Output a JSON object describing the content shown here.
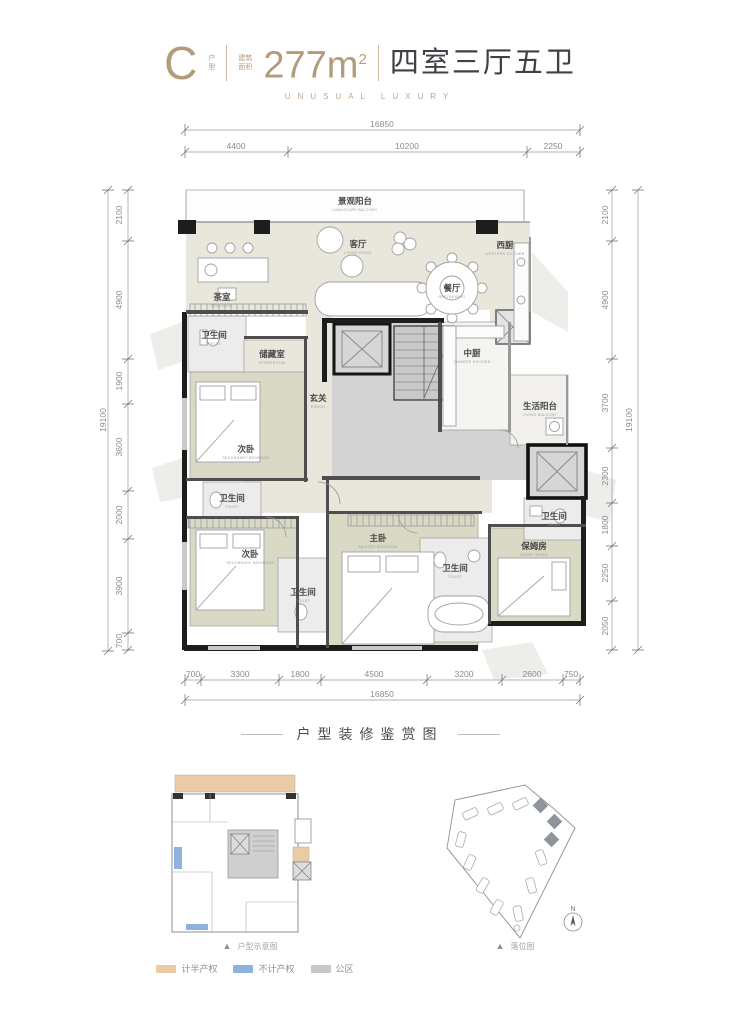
{
  "header": {
    "type_letter": "C",
    "type_suffix_top": "户",
    "type_suffix_bottom": "型",
    "area_prefix_top": "建筑",
    "area_prefix_bottom": "面积",
    "area_value": "277m",
    "area_sup": "2",
    "layout_text": "四室三厅五卫",
    "tagline": "UNUSUAL LUXURY"
  },
  "dims": {
    "top": {
      "total": "16850",
      "segments": [
        "4400",
        "10200",
        "2250"
      ]
    },
    "bottom": {
      "total": "16850",
      "segments": [
        "700",
        "3300",
        "1800",
        "4500",
        "3200",
        "2600",
        "750"
      ]
    },
    "left": {
      "total": "19100",
      "segments": [
        "2100",
        "4900",
        "1900",
        "3600",
        "2000",
        "3900",
        "700"
      ]
    },
    "right": {
      "total": "19100",
      "segments": [
        "2100",
        "4900",
        "3700",
        "2300",
        "1800",
        "2250",
        "2050"
      ]
    }
  },
  "rooms": {
    "balcony": {
      "name": "景观阳台",
      "en": "LANDSCAPE BALCONY"
    },
    "tearoom": {
      "name": "茶室",
      "en": "TEAHOUSE"
    },
    "living": {
      "name": "客厅",
      "en": "LIVING ROOM"
    },
    "dining": {
      "name": "餐厅",
      "en": "RESTAURANT"
    },
    "west_kitchen": {
      "name": "西厨",
      "en": "WESTERN KITCHEN"
    },
    "toilet1": {
      "name": "卫生间",
      "en": "TOILET"
    },
    "storeroom": {
      "name": "储藏室",
      "en": "STOREROOM"
    },
    "bedroom1": {
      "name": "次卧",
      "en": "SECONDARY BEDROOM"
    },
    "porch": {
      "name": "玄关",
      "en": "PORCH"
    },
    "chinese_kitchen": {
      "name": "中厨",
      "en": "CHINESE KITCHEN"
    },
    "life_balcony": {
      "name": "生活阳台",
      "en": "LIVING BALCONY"
    },
    "toilet2": {
      "name": "卫生间",
      "en": "TOILET"
    },
    "bedroom2": {
      "name": "次卧",
      "en": "SECONDARY BEDROOM"
    },
    "toilet3": {
      "name": "卫生间",
      "en": "TOILET"
    },
    "master": {
      "name": "主卧",
      "en": "MASTER BEDROOM"
    },
    "toilet4": {
      "name": "卫生间",
      "en": "TOILET"
    },
    "nanny": {
      "name": "保姆房",
      "en": "NANNY ROOM"
    },
    "toilet5": {
      "name": "卫生间",
      "en": "TOILET"
    }
  },
  "section2": {
    "title": "户型装修鉴赏图",
    "left_caption": "户型示意图",
    "right_caption": "落位图",
    "compass": "N",
    "legend": [
      {
        "label": "计半产权",
        "color": "#e9cba4"
      },
      {
        "label": "不计产权",
        "color": "#8fb2dd"
      },
      {
        "label": "公区",
        "color": "#c8c8c8"
      }
    ]
  },
  "colors": {
    "accent_tan": "#b49b7c",
    "title_dark": "#3e4247",
    "wall_black": "#1d1d1d",
    "floor_beige": "#e9e6dc",
    "floor_sage": "#d9d9c6",
    "floor_bath": "#ececec",
    "core_gray": "#d3d3d3",
    "dim_gray": "#8a8a8a"
  }
}
